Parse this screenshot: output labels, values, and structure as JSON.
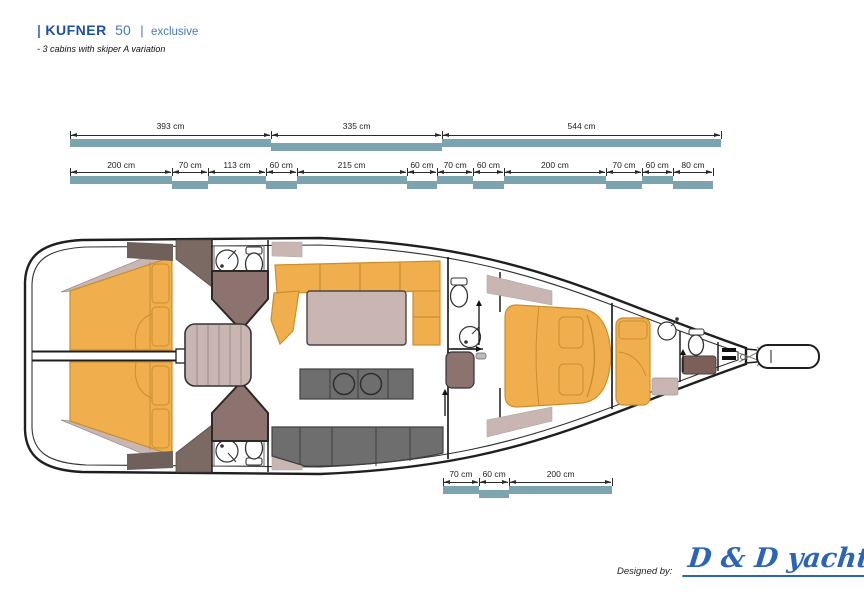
{
  "header": {
    "brand_pipe": "|",
    "brand": "KUFNER",
    "model": "50",
    "divider": "|",
    "edition": "exclusive",
    "subtitle": "- 3 cabins with skiper A variation"
  },
  "dimension_rows": {
    "unit": "cm",
    "top": {
      "segments": [
        {
          "cm": 393,
          "label": "393 cm"
        },
        {
          "cm": 335,
          "label": "335 cm"
        },
        {
          "cm": 544,
          "label": "544 cm"
        }
      ]
    },
    "middle": {
      "segments": [
        {
          "cm": 200,
          "label": "200 cm"
        },
        {
          "cm": 70,
          "label": "70 cm"
        },
        {
          "cm": 113,
          "label": "113 cm"
        },
        {
          "cm": 60,
          "label": "60 cm"
        },
        {
          "cm": 215,
          "label": "215 cm"
        },
        {
          "cm": 60,
          "label": "60 cm"
        },
        {
          "cm": 70,
          "label": "70 cm"
        },
        {
          "cm": 60,
          "label": "60 cm"
        },
        {
          "cm": 200,
          "label": "200 cm"
        },
        {
          "cm": 70,
          "label": "70 cm"
        },
        {
          "cm": 60,
          "label": "60 cm"
        },
        {
          "cm": 80,
          "label": "80 cm"
        }
      ]
    },
    "bottom": {
      "segments": [
        {
          "cm": 70,
          "label": "70 cm"
        },
        {
          "cm": 60,
          "label": "60 cm"
        },
        {
          "cm": 200,
          "label": "200 cm"
        }
      ]
    }
  },
  "footer": {
    "designed_by": "Designed by:",
    "studio": "D & D yachts"
  },
  "colors": {
    "blue-dark": "#1E4FA1",
    "blue-mid": "#4878BE",
    "teal": "#7CA4AE",
    "wood": "#F0AF4C",
    "wood-line": "#C98F2E",
    "galley": "#6E6E6E",
    "galley-line": "#3F3F3F",
    "mauve": "#8D7370",
    "trim": "#C9B6B2",
    "brown": "#7B5F58",
    "wardrobe": "#7B6A64",
    "brown-dark": "#6F605C",
    "logo-blue": "#2B64B8",
    "ink": "#1F1F1F"
  }
}
